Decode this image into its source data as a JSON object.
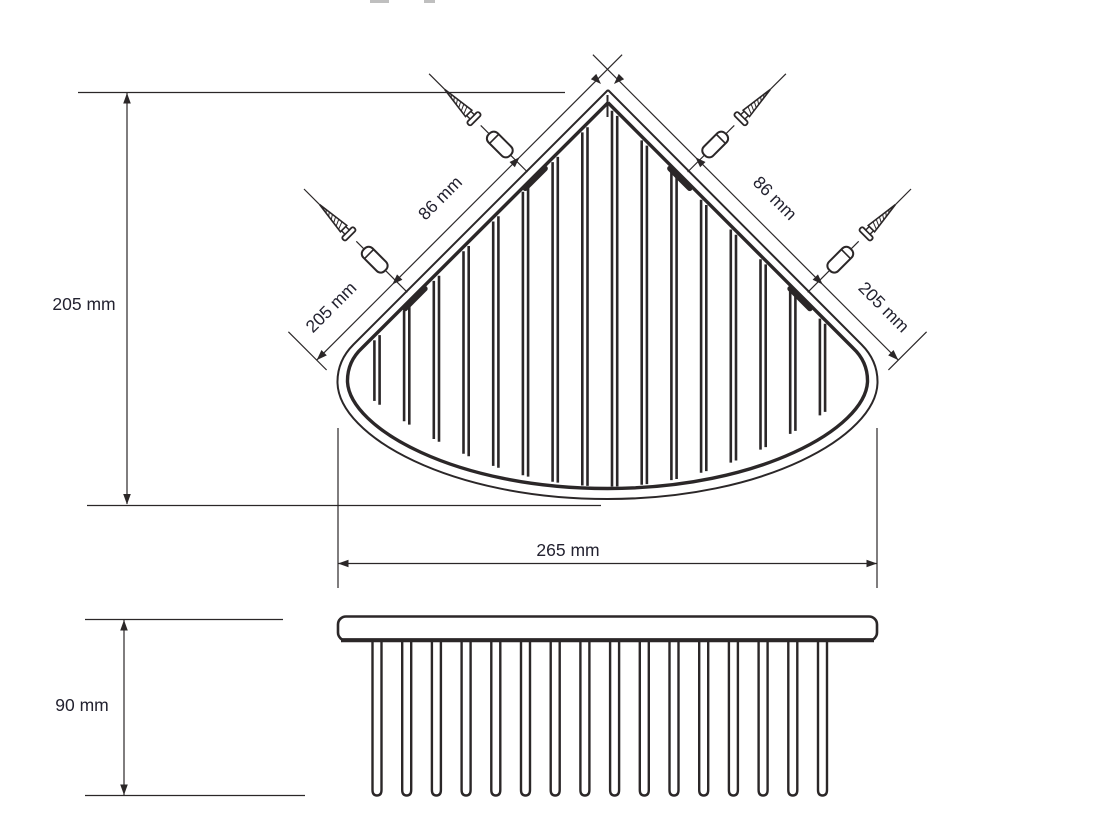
{
  "drawing": {
    "kind": "technical-dimension-drawing",
    "subject": "corner wire basket, top view and side view",
    "colors": {
      "line": "#2b2728",
      "text": "#232230",
      "background": "#ffffff"
    },
    "dimensions": {
      "left_depth": "205 mm",
      "left_hole_spacing": "86 mm",
      "left_wall_span": "205 mm",
      "right_hole_spacing": "86 mm",
      "right_wall_span": "205 mm",
      "front_width": "265 mm",
      "side_height": "90 mm"
    },
    "top_view": {
      "wire_count": 16,
      "mounting_tab_count": 4,
      "screw_count": 4
    },
    "side_view": {
      "prong_count": 16
    }
  }
}
